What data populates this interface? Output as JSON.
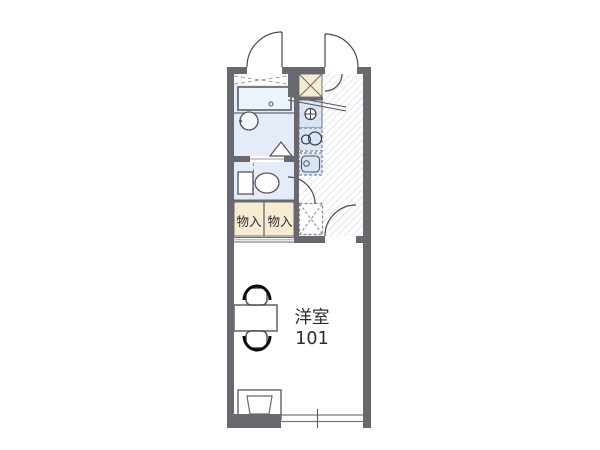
{
  "rooms": {
    "western_room": {
      "name": "洋室",
      "number": "101"
    },
    "storage_left": {
      "label": "物入"
    },
    "storage_right": {
      "label": "物入"
    }
  },
  "colors": {
    "wall": "#68686f",
    "bath_fill": "#e3ecf8",
    "kitchen_fill": "#d9e6f5",
    "storage_fill": "#f6ecd2",
    "hatch_line": "#c9ced4",
    "outline": "#55555b",
    "background": "#ffffff",
    "text": "#2b2b2b"
  }
}
